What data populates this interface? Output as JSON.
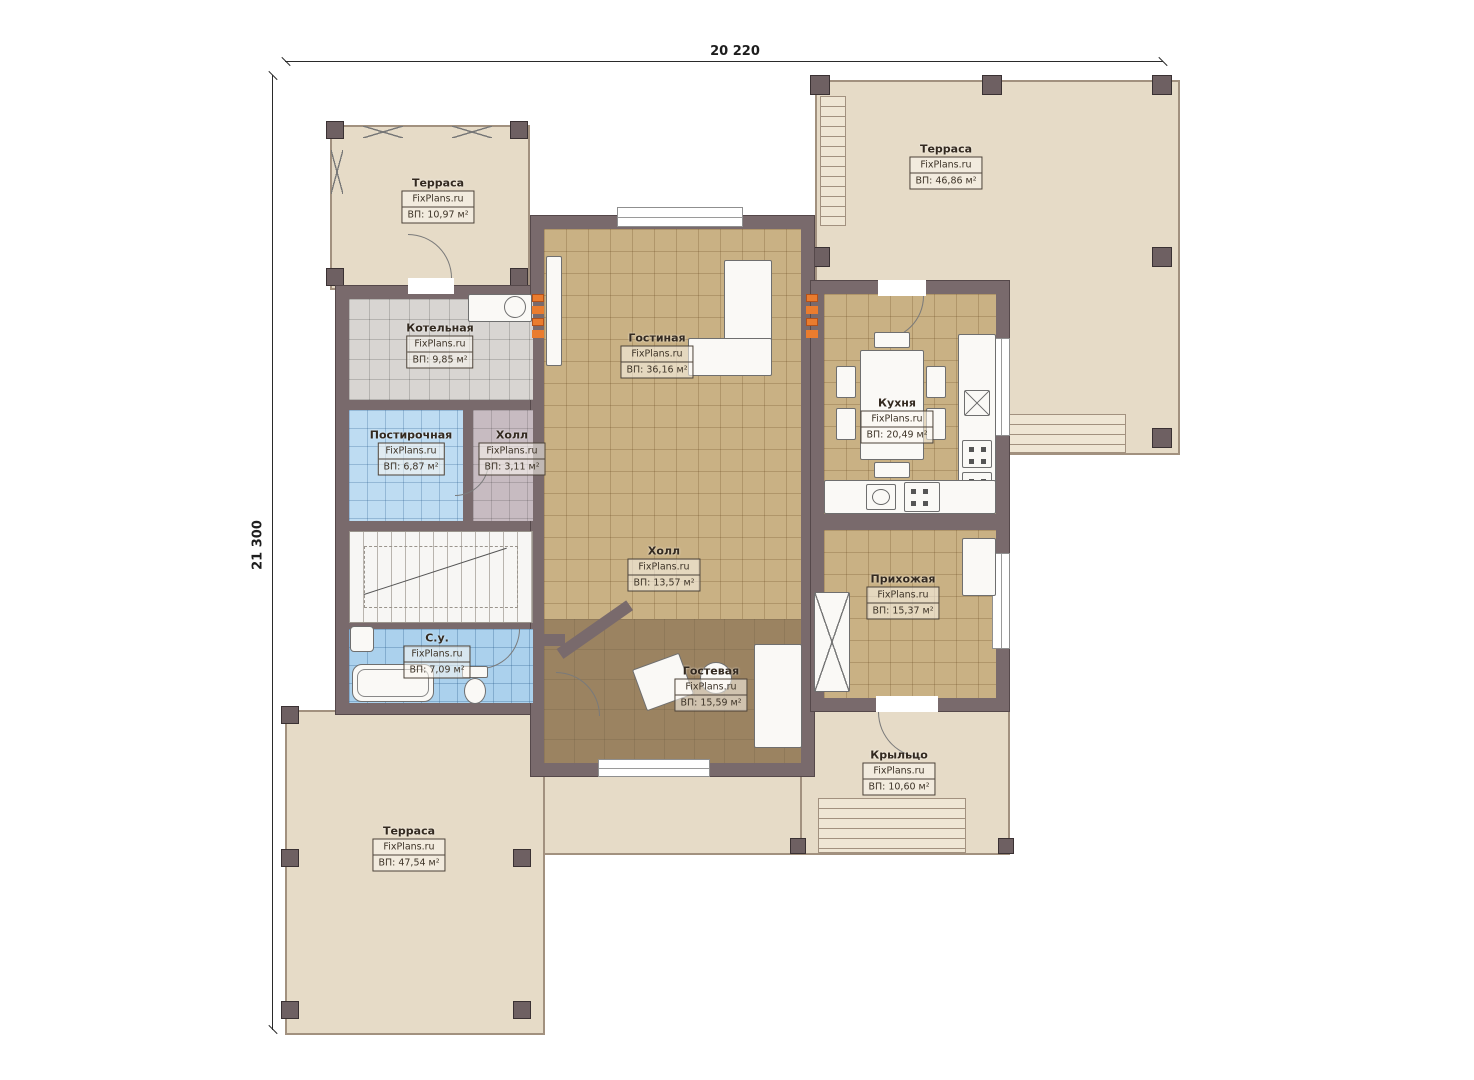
{
  "dimensions": {
    "top": "20 220",
    "left": "21 300"
  },
  "brand": "FixPlans.ru",
  "rooms": {
    "terrace_tl": {
      "name": "Терраса",
      "brand": "FixPlans.ru",
      "area": "ВП: 10,97 м²"
    },
    "terrace_tr": {
      "name": "Терраса",
      "brand": "FixPlans.ru",
      "area": "ВП: 46,86 м²"
    },
    "kotelnaya": {
      "name": "Котельная",
      "brand": "FixPlans.ru",
      "area": "ВП: 9,85 м²"
    },
    "gostinaya": {
      "name": "Гостиная",
      "brand": "FixPlans.ru",
      "area": "ВП: 36,16 м²"
    },
    "kuhnya": {
      "name": "Кухня",
      "brand": "FixPlans.ru",
      "area": "ВП: 20,49 м²"
    },
    "postirochnaya": {
      "name": "Постирочная",
      "brand": "FixPlans.ru",
      "area": "ВП: 6,87 м²"
    },
    "holl_small": {
      "name": "Холл",
      "brand": "FixPlans.ru",
      "area": "ВП: 3,11 м²"
    },
    "holl": {
      "name": "Холл",
      "brand": "FixPlans.ru",
      "area": "ВП: 13,57 м²"
    },
    "prihozhaya": {
      "name": "Прихожая",
      "brand": "FixPlans.ru",
      "area": "ВП: 15,37 м²"
    },
    "gostevaya": {
      "name": "Гостевая",
      "brand": "FixPlans.ru",
      "area": "ВП: 15,59 м²"
    },
    "su": {
      "name": "С.у.",
      "brand": "FixPlans.ru",
      "area": "ВП: 7,09 м²"
    },
    "krylco": {
      "name": "Крыльцо",
      "brand": "FixPlans.ru",
      "area": "ВП: 10,60 м²"
    },
    "terrace_bl": {
      "name": "Терраса",
      "brand": "FixPlans.ru",
      "area": "ВП: 47,54 м²"
    }
  },
  "colors": {
    "wall": "#796a6c",
    "terrace_fill": "#e6dbc7",
    "floor_tan": "#c9b184",
    "floor_gray": "#d8d5d2",
    "floor_blue": "#abd1ed",
    "floor_brown": "#9b8361",
    "radiator": "#ea7c2e"
  }
}
